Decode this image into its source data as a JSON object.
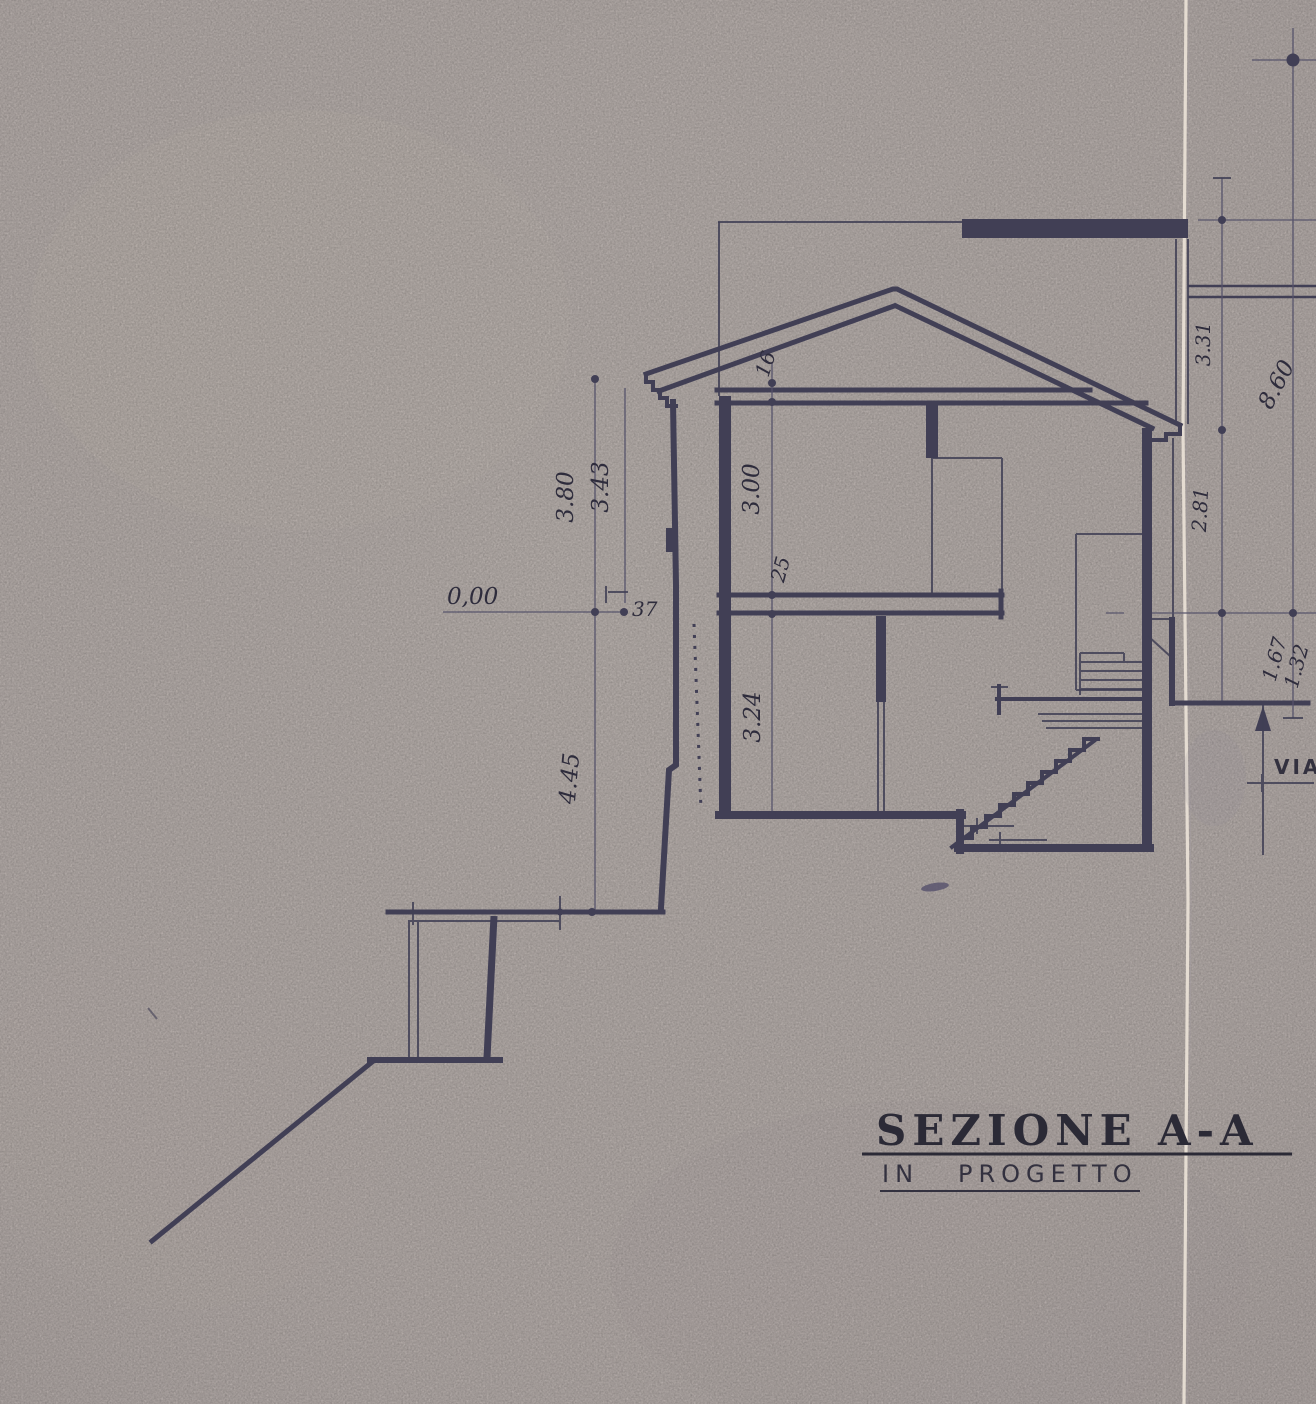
{
  "sheet": {
    "title": {
      "word1": "SEZIONE",
      "word2": "A-A"
    },
    "subtitle": {
      "word1": "IN",
      "word2": "PROGETTO"
    },
    "street_label": "VIA"
  },
  "dimensions": {
    "datum_level": "0,00",
    "left_height_total": "3.80",
    "left_height_inner": "3.43",
    "left_depth_below_datum": "4.45",
    "wall_thickness_cm": "37",
    "attic_slab_thickness_cm": "16",
    "first_floor_room_height": "3.00",
    "floor_slab_thickness_cm": "25",
    "ground_floor_room_height": "3.24",
    "right_parapet_to_eave": "3.31",
    "right_total_height": "8.60",
    "right_eave_to_datum": "2.81",
    "datum_to_street_a": "1.67",
    "datum_to_street_b": "1.32"
  },
  "colors": {
    "paper": "#c9c0bc",
    "ink": "#413f55",
    "ink_dark": "#2e2c3c",
    "crease_light": "#ece3d8"
  }
}
